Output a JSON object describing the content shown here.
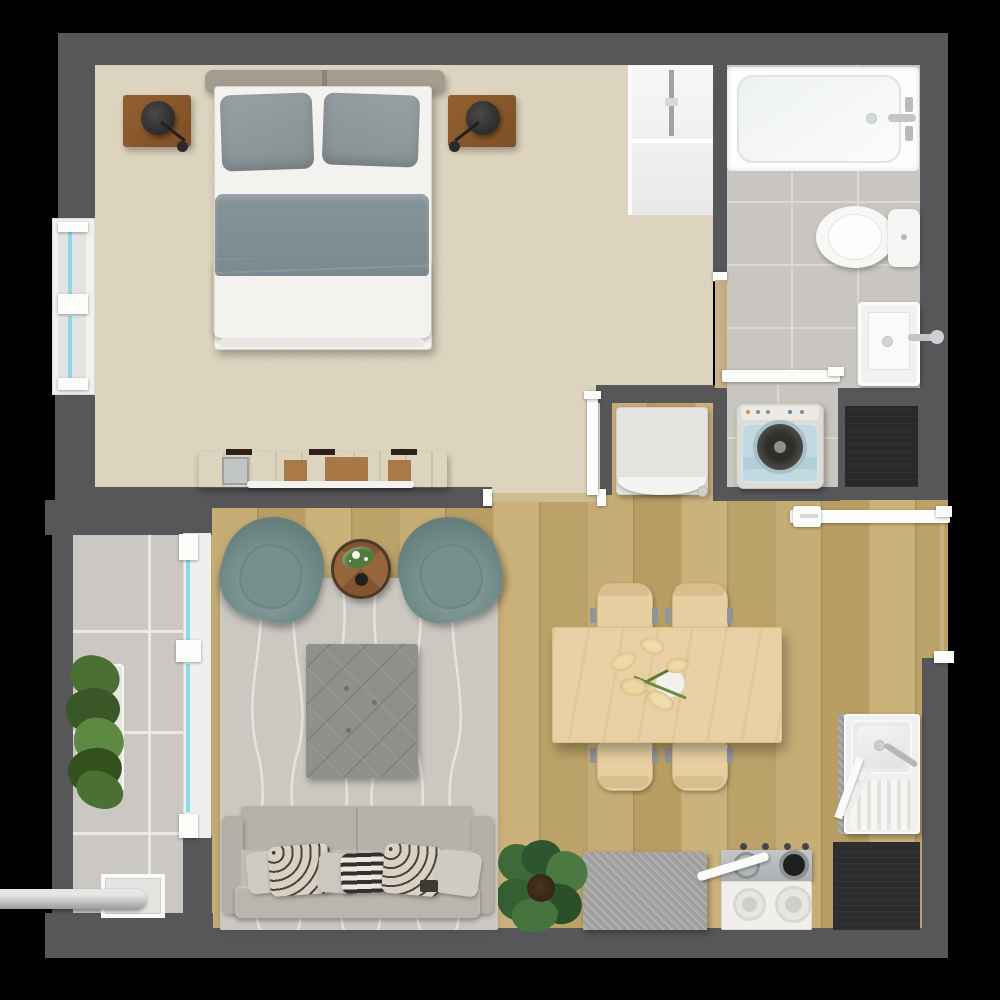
{
  "meta": {
    "title": "One-bedroom apartment floor plan — top-down 3D render",
    "canvas_px": "1000x1000"
  },
  "palette": {
    "background": "#000000",
    "wall": "#57575a",
    "carpet": "#dcd3bd",
    "wood_floor": "#c1a871",
    "tile_floor": "#c9c5c0",
    "balcony_tile": "#cbc7c2",
    "rug": "#cbc8c1",
    "accent_teal_chairs": "#6c8684",
    "wood_furniture_dark": "#7a4b27",
    "wood_furniture_light": "#e8d0a4",
    "window_glass": "#8fd8e8",
    "service_shaft": "#29292b",
    "dark_counter": "#2d2d2f"
  },
  "rooms": {
    "bedroom": {
      "label": "Bedroom",
      "furniture": [
        "double bed",
        "gray pillows",
        "gray duvet",
        "headboard",
        "left nightstand",
        "right nightstand",
        "left wall lamp",
        "right wall lamp",
        "media dresser",
        "built-in closet with rail",
        "exterior window"
      ]
    },
    "bathroom": {
      "label": "Bathroom",
      "furniture": [
        "bathtub with faucet",
        "toilet with tank",
        "shower basin with faucet",
        "white sliding door",
        "tan connecting door"
      ]
    },
    "laundry": {
      "label": "Laundry nook",
      "furniture": [
        "top-load washing machine",
        "refrigerator in niche",
        "service shaft"
      ]
    },
    "living": {
      "label": "Living room",
      "furniture": [
        "three-seat sofa with cushions",
        "tufted ottoman",
        "left teal armchair",
        "right teal armchair",
        "round wooden side table with plant and cup",
        "patterned area rug",
        "monstera floor plant"
      ]
    },
    "kitchen": {
      "label": "Kitchen / dining",
      "furniture": [
        "dining table with flower centerpiece",
        "four wooden chairs",
        "kitchen sink with drainboard",
        "four-burner gas stove",
        "granite counter",
        "dark counter",
        "open entry door"
      ]
    },
    "balcony": {
      "label": "Balcony",
      "furniture": [
        "green planter",
        "floor drain",
        "drain pipe",
        "sliding glass door"
      ]
    }
  }
}
